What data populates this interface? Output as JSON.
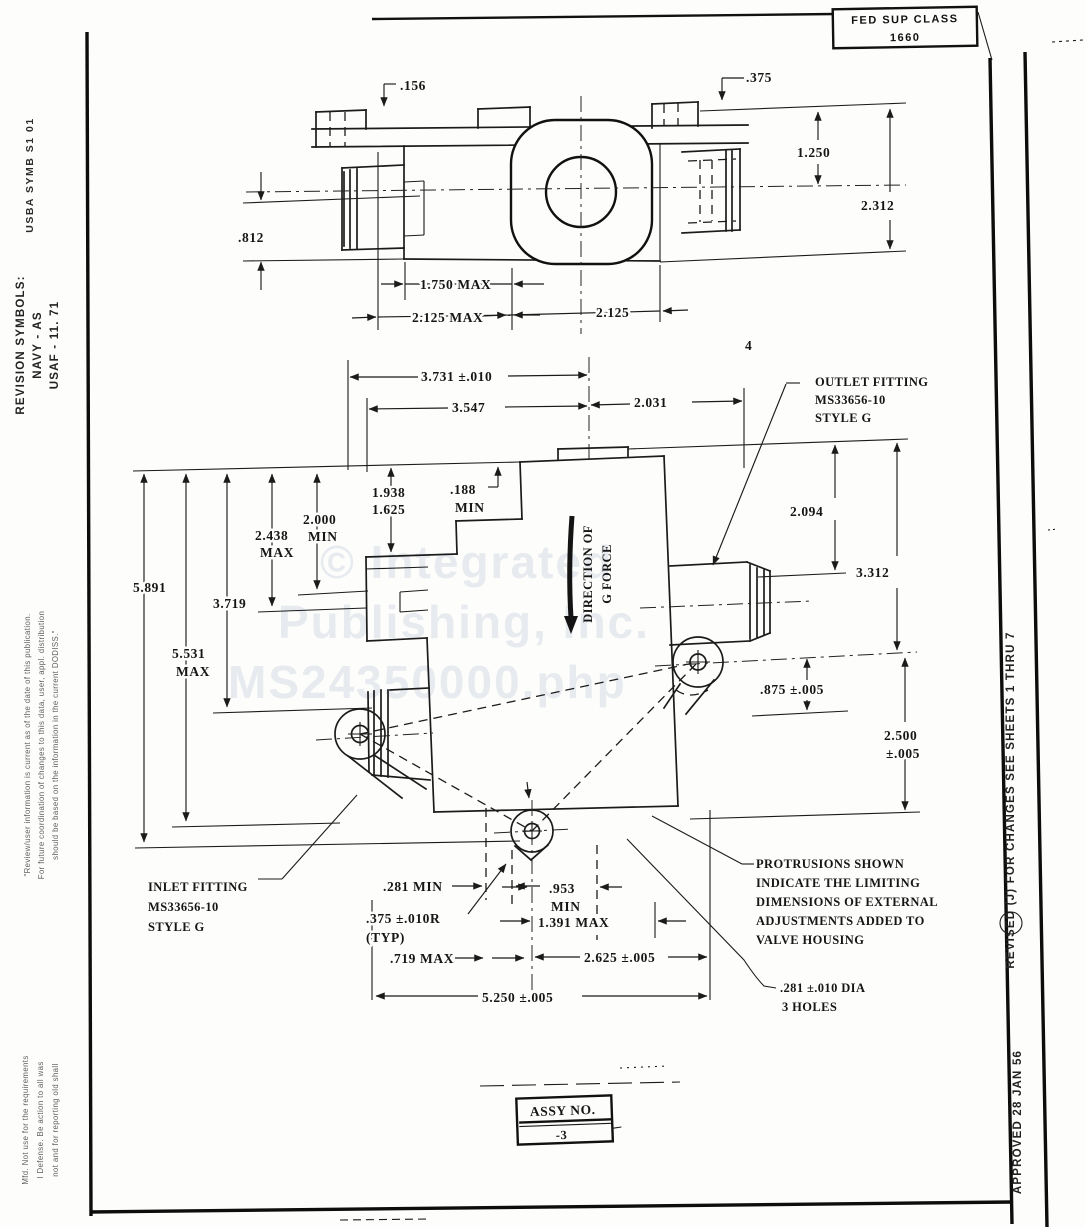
{
  "page": {
    "fed_sup_class_label": "FED SUP CLASS",
    "fed_sup_class_value": "1660",
    "corner_mark": "4"
  },
  "watermark": {
    "line1": "© Integrated",
    "line2": "Publishing, Inc.",
    "line3": "MS24350000.php"
  },
  "left_margin": {
    "user_symb": "USBA SYMB S1 01",
    "revision_title": "REVISION SYMBOLS:",
    "revision_navy": "NAVY - AS",
    "revision_usaf": "USAF - 11. 71",
    "note_line1": "\"Review/user information is current as of the date of this publication.",
    "note_line2": "For future coordination of changes to this data, user, appl. distribution",
    "note_line3": "should be based on the information in the current DODISS.\"",
    "bottom_line1": "Mfd. Not use for the requirements",
    "bottom_line2": "I Defense. Be action to all was",
    "bottom_line3": "not and for reporting old shall"
  },
  "right_margin": {
    "revised": "REVISED   (J)   FOR CHANGES SEE SHEETS 1 THRU 7",
    "approved": "APPROVED 28 JAN 56"
  },
  "top_view": {
    "d156": ".156",
    "d375": ".375",
    "d1250": "1.250",
    "d2312": "2.312",
    "d812": ".812",
    "d1750": "1.750 MAX",
    "d2125max": "2.125 MAX",
    "d2125": "2.125"
  },
  "main_view": {
    "outlet_line1": "OUTLET FITTING",
    "outlet_line2": "MS33656-10",
    "outlet_line3": "STYLE G",
    "inlet_line1": "INLET FITTING",
    "inlet_line2": "MS33656-10",
    "inlet_line3": "STYLE G",
    "gforce_line1": "DIRECTION OF",
    "gforce_line2": "G FORCE",
    "d3731": "3.731 ±.010",
    "d3547": "3.547",
    "d2031": "2.031",
    "d188": ".188",
    "d188b": "MIN",
    "d1938": "1.938",
    "d1625": "1.625",
    "d2438": "2.438",
    "d2438b": "MAX",
    "d2000": "2.000",
    "d2000b": "MIN",
    "d5891": "5.891",
    "d3719": "3.719",
    "d5531": "5.531",
    "d5531b": "MAX",
    "d2094": "2.094",
    "d3312": "3.312",
    "d875": ".875 ±.005",
    "d2500": "2.500",
    "d2500b": "±.005",
    "d281min": ".281 MIN",
    "d375r": ".375 ±.010R",
    "d375r2": "(TYP)",
    "d719": ".719 MAX",
    "d953": ".953",
    "d953b": "MIN",
    "d1391": "1.391 MAX",
    "d2625": "2.625 ±.005",
    "d5250": "5.250 ±.005",
    "holes_line1": ".281 ±.010 DIA",
    "holes_line2": "3 HOLES",
    "protrusion_note": [
      "PROTRUSIONS SHOWN",
      "INDICATE THE LIMITING",
      "DIMENSIONS OF EXTERNAL",
      "ADJUSTMENTS ADDED TO",
      "VALVE HOUSING"
    ]
  },
  "assy": {
    "label": "ASSY NO.",
    "value": "-3"
  }
}
